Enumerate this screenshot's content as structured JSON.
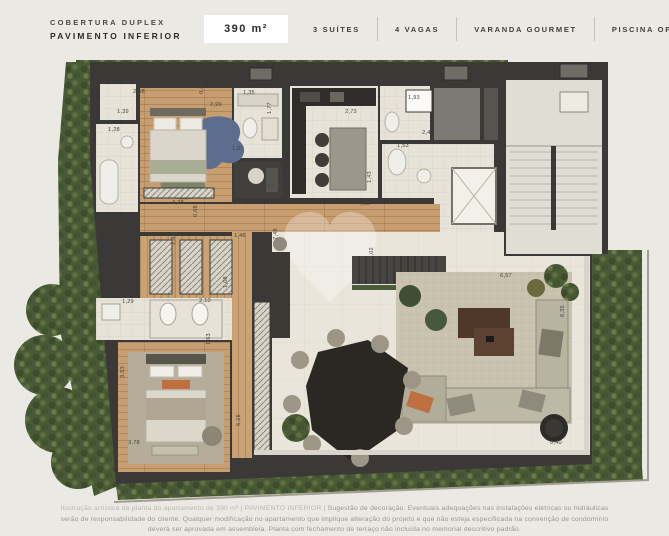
{
  "header": {
    "project_type": "COBERTURA DUPLEX",
    "floor_label": "PAVIMENTO INFERIOR",
    "area_badge": "390 m²",
    "features": [
      {
        "label": "3 SUÍTES"
      },
      {
        "label": "4 VAGAS"
      },
      {
        "label": "VARANDA GOURMET"
      },
      {
        "label": "PISCINA OPCIONAL"
      }
    ]
  },
  "floor_plan": {
    "watermark_icon": "heart-watermark",
    "colors": {
      "background": "#ebe9e3",
      "wall": "#3b3937",
      "wood_floor": "#c89d70",
      "tile_floor": "#e7e3d8",
      "stone_floor": "#e9e5da",
      "greenery": "#4a5a36",
      "stair_core": "#e0ddd4",
      "outdoor_rug": "#c9c2ae"
    },
    "dimension_labels": [
      {
        "text": "1,10",
        "x": 97,
        "y": 86,
        "vertical": true
      },
      {
        "text": "2,58",
        "x": 139,
        "y": 93,
        "vertical": false
      },
      {
        "text": "0,44",
        "x": 203,
        "y": 88,
        "vertical": true
      },
      {
        "text": "2,99",
        "x": 216,
        "y": 106,
        "vertical": false
      },
      {
        "text": "1,39",
        "x": 123,
        "y": 113,
        "vertical": false
      },
      {
        "text": "1,35",
        "x": 249,
        "y": 94,
        "vertical": false
      },
      {
        "text": "1,77",
        "x": 271,
        "y": 108,
        "vertical": true
      },
      {
        "text": "1,28",
        "x": 114,
        "y": 131,
        "vertical": false
      },
      {
        "text": "2,56",
        "x": 93,
        "y": 138,
        "vertical": true
      },
      {
        "text": "1,07",
        "x": 238,
        "y": 150,
        "vertical": false
      },
      {
        "text": "1,10",
        "x": 240,
        "y": 186,
        "vertical": true
      },
      {
        "text": "1,67",
        "x": 268,
        "y": 188,
        "vertical": false
      },
      {
        "text": "2,73",
        "x": 351,
        "y": 113,
        "vertical": false
      },
      {
        "text": "1,93",
        "x": 414,
        "y": 99,
        "vertical": false
      },
      {
        "text": "2,47",
        "x": 428,
        "y": 134,
        "vertical": false
      },
      {
        "text": "1,53",
        "x": 403,
        "y": 147,
        "vertical": false
      },
      {
        "text": "1,43",
        "x": 371,
        "y": 177,
        "vertical": true
      },
      {
        "text": "3,57",
        "x": 285,
        "y": 187,
        "vertical": true
      },
      {
        "text": "4,05",
        "x": 364,
        "y": 205,
        "vertical": false
      },
      {
        "text": "7,48",
        "x": 277,
        "y": 234,
        "vertical": true
      },
      {
        "text": "3,28",
        "x": 178,
        "y": 204,
        "vertical": false
      },
      {
        "text": "0,68",
        "x": 197,
        "y": 211,
        "vertical": true
      },
      {
        "text": "1,70",
        "x": 237,
        "y": 204,
        "vertical": false
      },
      {
        "text": "1,88",
        "x": 175,
        "y": 239,
        "vertical": true
      },
      {
        "text": "1,46",
        "x": 240,
        "y": 237,
        "vertical": false
      },
      {
        "text": "1,08",
        "x": 227,
        "y": 282,
        "vertical": true
      },
      {
        "text": "1,29",
        "x": 128,
        "y": 303,
        "vertical": false
      },
      {
        "text": "2,10",
        "x": 205,
        "y": 302,
        "vertical": false
      },
      {
        "text": "1,63",
        "x": 210,
        "y": 339,
        "vertical": true
      },
      {
        "text": "3,53",
        "x": 124,
        "y": 372,
        "vertical": true
      },
      {
        "text": "3,78",
        "x": 134,
        "y": 444,
        "vertical": false
      },
      {
        "text": "6,16",
        "x": 240,
        "y": 420,
        "vertical": true
      },
      {
        "text": "2,02",
        "x": 373,
        "y": 253,
        "vertical": true
      },
      {
        "text": "6,57",
        "x": 506,
        "y": 277,
        "vertical": false
      },
      {
        "text": "6,35",
        "x": 564,
        "y": 311,
        "vertical": true
      },
      {
        "text": "0,40",
        "x": 556,
        "y": 444,
        "vertical": false
      }
    ]
  },
  "footer": {
    "caption_prefix": "Ilustração artística da planta do apartamento de 390 m² | PAVIMENTO INFERIOR | ",
    "caption_body": "Sugestão de decoração. Eventuais adequações nas instalações elétricas ou hidráulicas serão de responsabilidade do cliente. Qualquer modificação no apartamento que implique alteração do projeto e que não esteja especificada na convenção de condomínio deverá ser aprovada em assembleia. Planta com fechamento de terraço não incluída no memorial descritivo padrão."
  }
}
